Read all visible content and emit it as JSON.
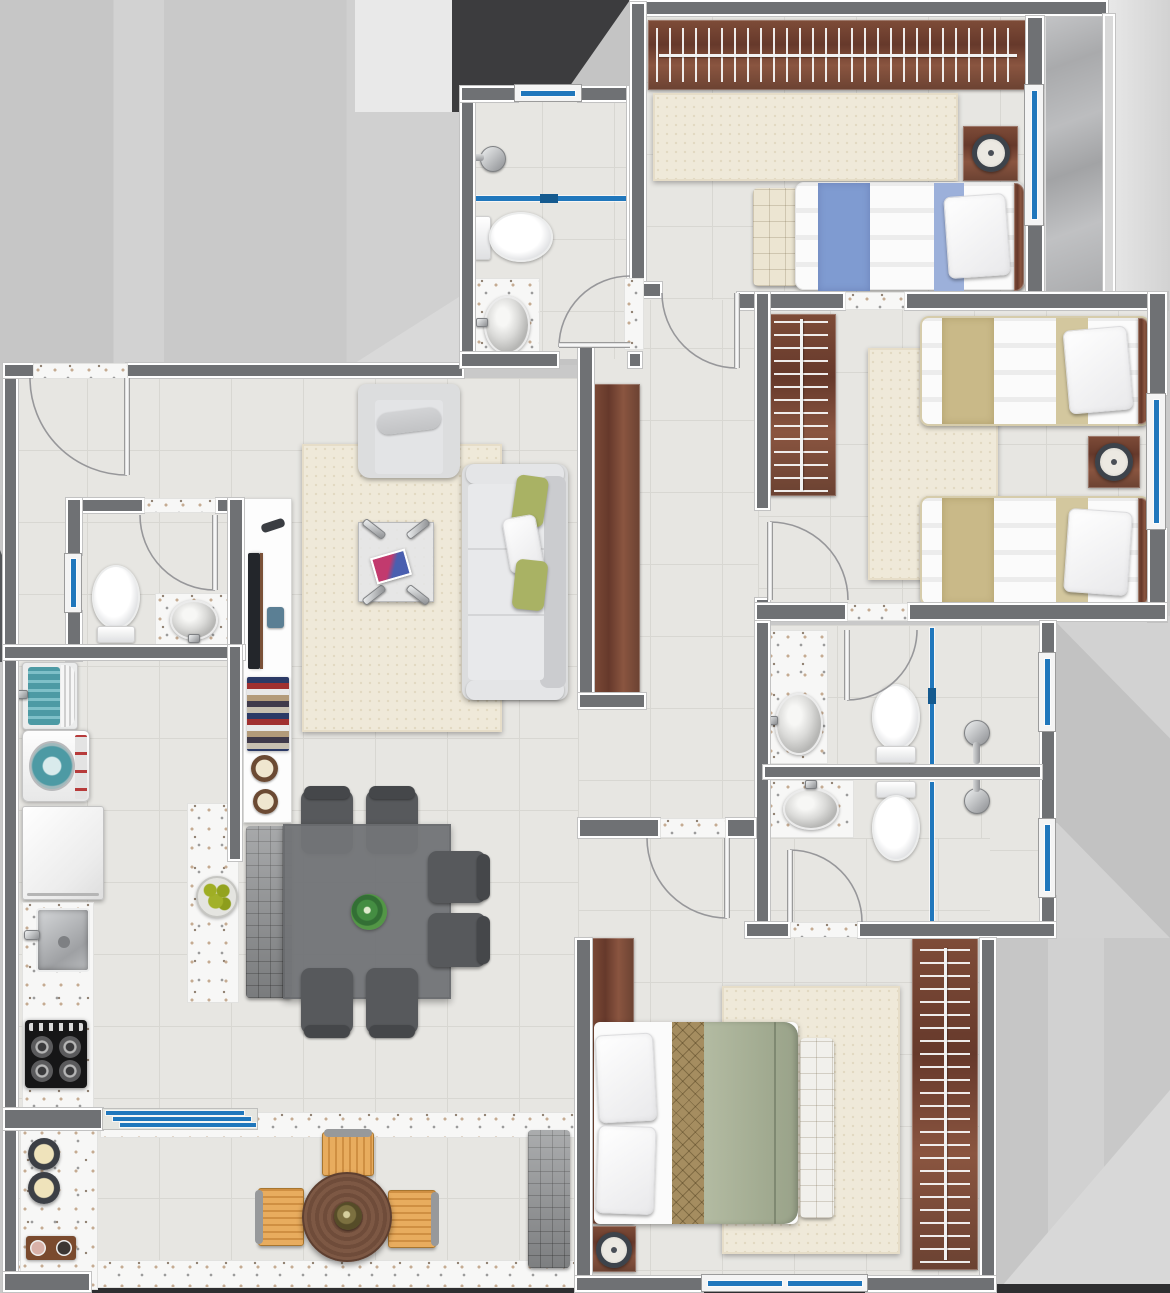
{
  "title": "apartment-floor-plan",
  "palette": {
    "outside_base": "#c9c9c9",
    "outside_band": "#d4d4d4",
    "outside_light": "#e9e9e9",
    "outside_dark": "#3c3c3e",
    "wall": "#6f7174",
    "floor": "#e7e6e2",
    "floor_line": "#d8d7d2",
    "terrazzo": "#f7f7f6",
    "wood_dark": "#6b4134",
    "marble": "#b2b3b5",
    "glass_blue": "#2077bc",
    "rug": "#efe9d9",
    "sofa": "#dcddde",
    "pillow_green": "#a9b264",
    "bed_white": "#fbfbfb",
    "bed_blue": "#7f9bd1",
    "bed_tan": "#c9b988",
    "bed_sage": "#a8b197",
    "runner_tan": "#a58d60",
    "dining_dark": "#57595c",
    "dining_table": "#737578",
    "bench_gray": "#8f9193",
    "balcony_chair": "#dfa255",
    "balcony_table": "#7a5642",
    "appliance_teal": "#4d9aa4",
    "apple_green": "#97a622",
    "chrome": "#9fa1a4"
  },
  "rooms": [
    {
      "name": "foyer",
      "items": [
        "entry-door"
      ]
    },
    {
      "name": "social-bathroom",
      "items": [
        "shower-head",
        "glass-partition",
        "toilet",
        "sink"
      ]
    },
    {
      "name": "bedroom-1",
      "items": [
        "wardrobe",
        "rug",
        "single-bed-blue",
        "foot-bench",
        "nightstand-with-clock",
        "window"
      ]
    },
    {
      "name": "side-niche",
      "items": [
        "marble-panel",
        "windows"
      ]
    },
    {
      "name": "bedroom-2",
      "items": [
        "wardrobe",
        "rug",
        "twin-bed",
        "twin-bed",
        "nightstand-with-clock",
        "window"
      ]
    },
    {
      "name": "bathroom-1",
      "items": [
        "sink-counter",
        "toilet",
        "glass-partition",
        "shower-head",
        "window"
      ]
    },
    {
      "name": "bathroom-2",
      "items": [
        "sink-counter",
        "toilet",
        "glass-partition",
        "shower-head",
        "window"
      ]
    },
    {
      "name": "living-room",
      "items": [
        "tv-console",
        "tv",
        "remote",
        "speaker",
        "magazine-stack",
        "armchair",
        "rug",
        "coffee-table",
        "magazine",
        "sofa",
        "cushions",
        "wood-panel"
      ]
    },
    {
      "name": "dining-area",
      "items": [
        "dining-table",
        "chair",
        "chair",
        "chair",
        "chair",
        "chair",
        "chair",
        "bench",
        "island-counter",
        "fruit-bowl",
        "plant-centerpiece"
      ]
    },
    {
      "name": "kitchen-laundry",
      "items": [
        "laundry-tub",
        "washing-machine",
        "refrigerator",
        "counter-with-sink",
        "gas-stove"
      ]
    },
    {
      "name": "powder-room",
      "items": [
        "toilet",
        "sink",
        "window"
      ]
    },
    {
      "name": "master-bedroom",
      "items": [
        "headboard-panel",
        "double-bed",
        "pillows",
        "rug",
        "foot-bench",
        "wardrobe",
        "nightstand-with-clock",
        "windows"
      ]
    },
    {
      "name": "balcony",
      "items": [
        "sliding-glass-door",
        "round-table",
        "chair",
        "chair",
        "chair",
        "lounger",
        "counter-with-bowls",
        "serving-tray"
      ]
    }
  ],
  "counts": {
    "windows": 8,
    "door-swings": 8,
    "bedrooms": 3,
    "bathrooms": 4
  }
}
